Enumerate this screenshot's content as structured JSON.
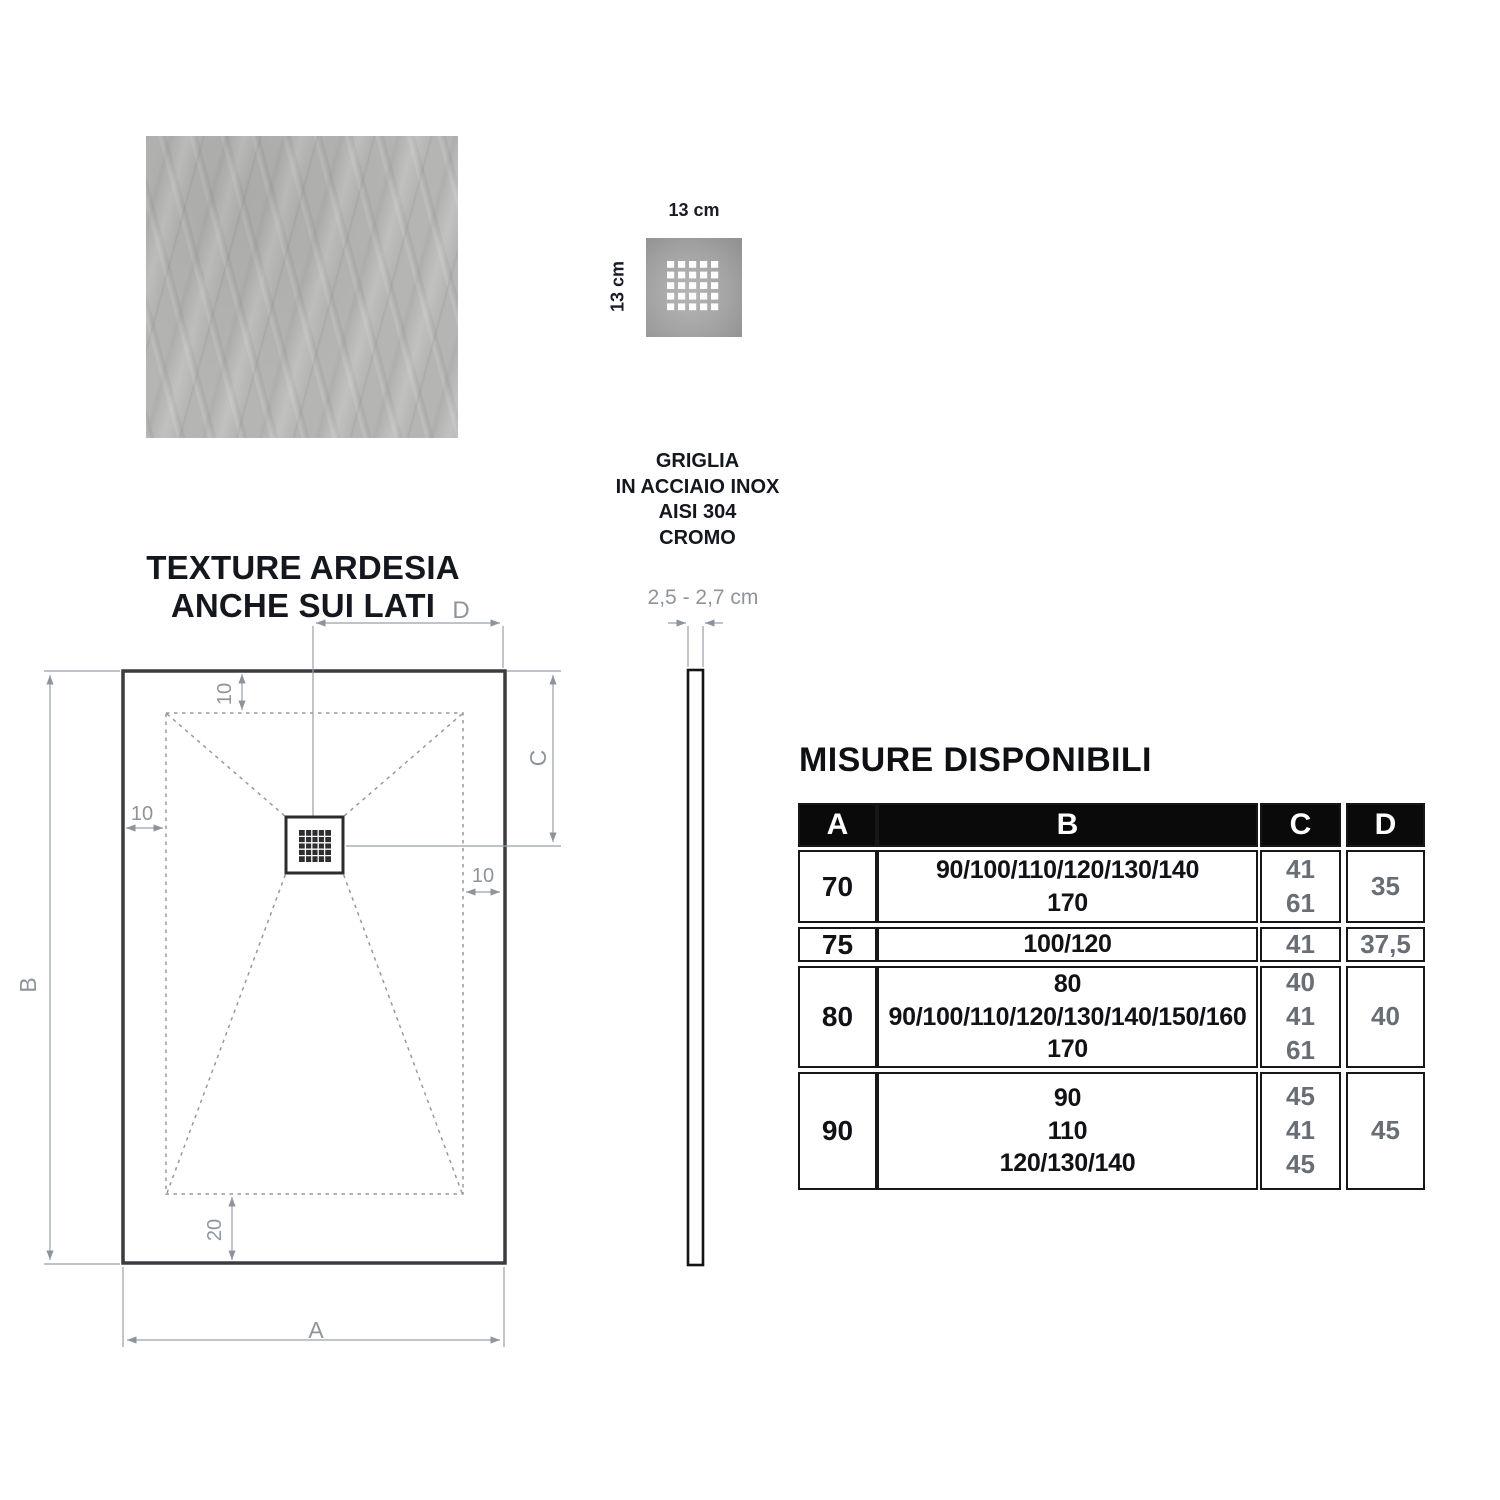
{
  "texture": {
    "title_line1": "TEXTURE ARDESIA",
    "title_line2": "ANCHE SUI LATI"
  },
  "grille": {
    "width_label": "13 cm",
    "height_label": "13 cm",
    "caption": [
      "GRIGLIA",
      "IN ACCIAIO INOX",
      "AISI 304",
      "CROMO"
    ]
  },
  "profile": {
    "thickness_label": "2,5 - 2,7 cm"
  },
  "plan_dims": {
    "width": "A",
    "height": "B",
    "drain_from_top": "C",
    "drain_from_edge": "D",
    "inset_top": "10",
    "inset_left": "10",
    "inset_right": "10",
    "inset_bottom": "20"
  },
  "table": {
    "title": "MISURE DISPONIBILI",
    "headers": [
      "A",
      "B",
      "C",
      "D"
    ],
    "rows": [
      {
        "a": "70",
        "b": [
          "90/100/110/120/130/140",
          "170"
        ],
        "c": [
          "41",
          "61"
        ],
        "d": "35"
      },
      {
        "a": "75",
        "b": [
          "100/120"
        ],
        "c": [
          "41"
        ],
        "d": "37,5"
      },
      {
        "a": "80",
        "b": [
          "80",
          "90/100/110/120/130/140/150/160",
          "170"
        ],
        "c": [
          "40",
          "41",
          "61"
        ],
        "d": "40"
      },
      {
        "a": "90",
        "b": [
          "90",
          "110",
          "120/130/140"
        ],
        "c": [
          "45",
          "41",
          "45"
        ],
        "d": "45"
      }
    ]
  },
  "colors": {
    "dim_grey": "#8f949c",
    "line_dark": "#3c3c40",
    "table_border": "#17171a",
    "header_bg": "#0a0a0a",
    "header_text": "#ffffff",
    "value_grey": "#686d76",
    "text_dark": "#15171f"
  }
}
